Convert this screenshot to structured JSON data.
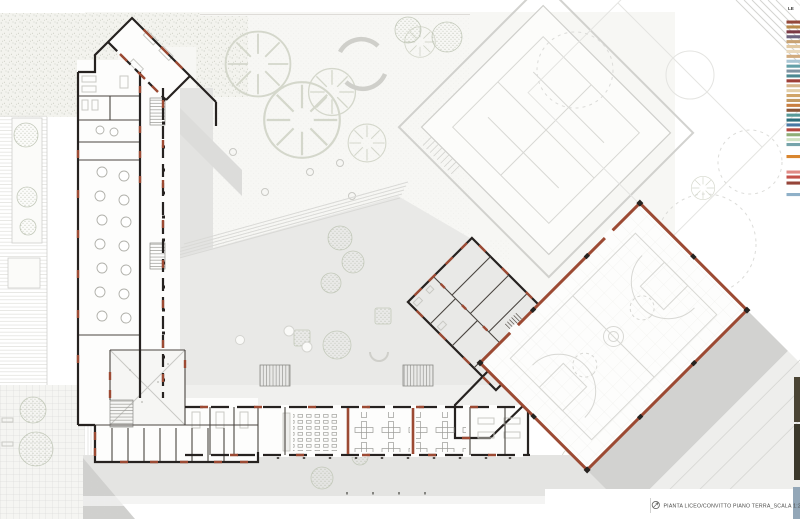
{
  "page": {
    "width": 800,
    "height": 519,
    "background": "#ffffff"
  },
  "caption": {
    "icon": "north-arrow-icon",
    "text": "PIANTA LICEO/CONVITTO PIANO TERRA_SCALA 1:200"
  },
  "legend": {
    "title": "LE",
    "chips": [
      {
        "y": 20.5,
        "c": "#94483a"
      },
      {
        "y": 25.4,
        "c": "#b98a4a"
      },
      {
        "y": 30.3,
        "c": "#7c3a44"
      },
      {
        "y": 35.2,
        "c": "#6d6580"
      },
      {
        "y": 40.1,
        "c": "#c8a273"
      },
      {
        "y": 45.0,
        "c": "#e2c9a2"
      },
      {
        "y": 49.9,
        "c": "#ead9bd"
      },
      {
        "y": 54.8,
        "c": "#d2ab7d"
      },
      {
        "y": 59.7,
        "c": "#a9c6d4"
      },
      {
        "y": 64.6,
        "c": "#63a0a8"
      },
      {
        "y": 69.5,
        "c": "#7e93a2"
      },
      {
        "y": 74.4,
        "c": "#4c8892"
      },
      {
        "y": 79.3,
        "c": "#9e3f38"
      },
      {
        "y": 84.2,
        "c": "#d7b68c"
      },
      {
        "y": 89.1,
        "c": "#e3cfa9"
      },
      {
        "y": 94.0,
        "c": "#d0a468"
      },
      {
        "y": 98.9,
        "c": "#c39a63"
      },
      {
        "y": 103.8,
        "c": "#c97f41"
      },
      {
        "y": 108.7,
        "c": "#8a5638"
      },
      {
        "y": 113.6,
        "c": "#579a98"
      },
      {
        "y": 118.5,
        "c": "#2e6f7c"
      },
      {
        "y": 123.4,
        "c": "#4878a4"
      },
      {
        "y": 128.3,
        "c": "#b5473f"
      },
      {
        "y": 133.2,
        "c": "#8fae77"
      },
      {
        "y": 138.1,
        "c": "#cfe2c2"
      },
      {
        "y": 143.0,
        "c": "#76a4ab"
      },
      {
        "y": 155.0,
        "c": "#d9862f"
      },
      {
        "y": 170.5,
        "c": "#e08a85"
      },
      {
        "y": 175.5,
        "c": "#c4524a"
      },
      {
        "y": 181.5,
        "c": "#96453a"
      },
      {
        "y": 193.0,
        "c": "#8fb0c8"
      }
    ]
  },
  "edge_strip": {
    "photo_top": "#4a4434",
    "photo_bottom": "#3b382b",
    "blue_panel": "#93a7b8"
  },
  "palette": {
    "wall_black": "#262220",
    "brick_red": "#9c4a33",
    "plaza_gray": "#e9e9e7",
    "arcade_gray": "#e3e3e1",
    "shadow_gray": "#d2d2d0",
    "courtyard": "#f7f7f4",
    "court_line": "#d8d8d4",
    "vegetation": "#c7cdbd"
  }
}
